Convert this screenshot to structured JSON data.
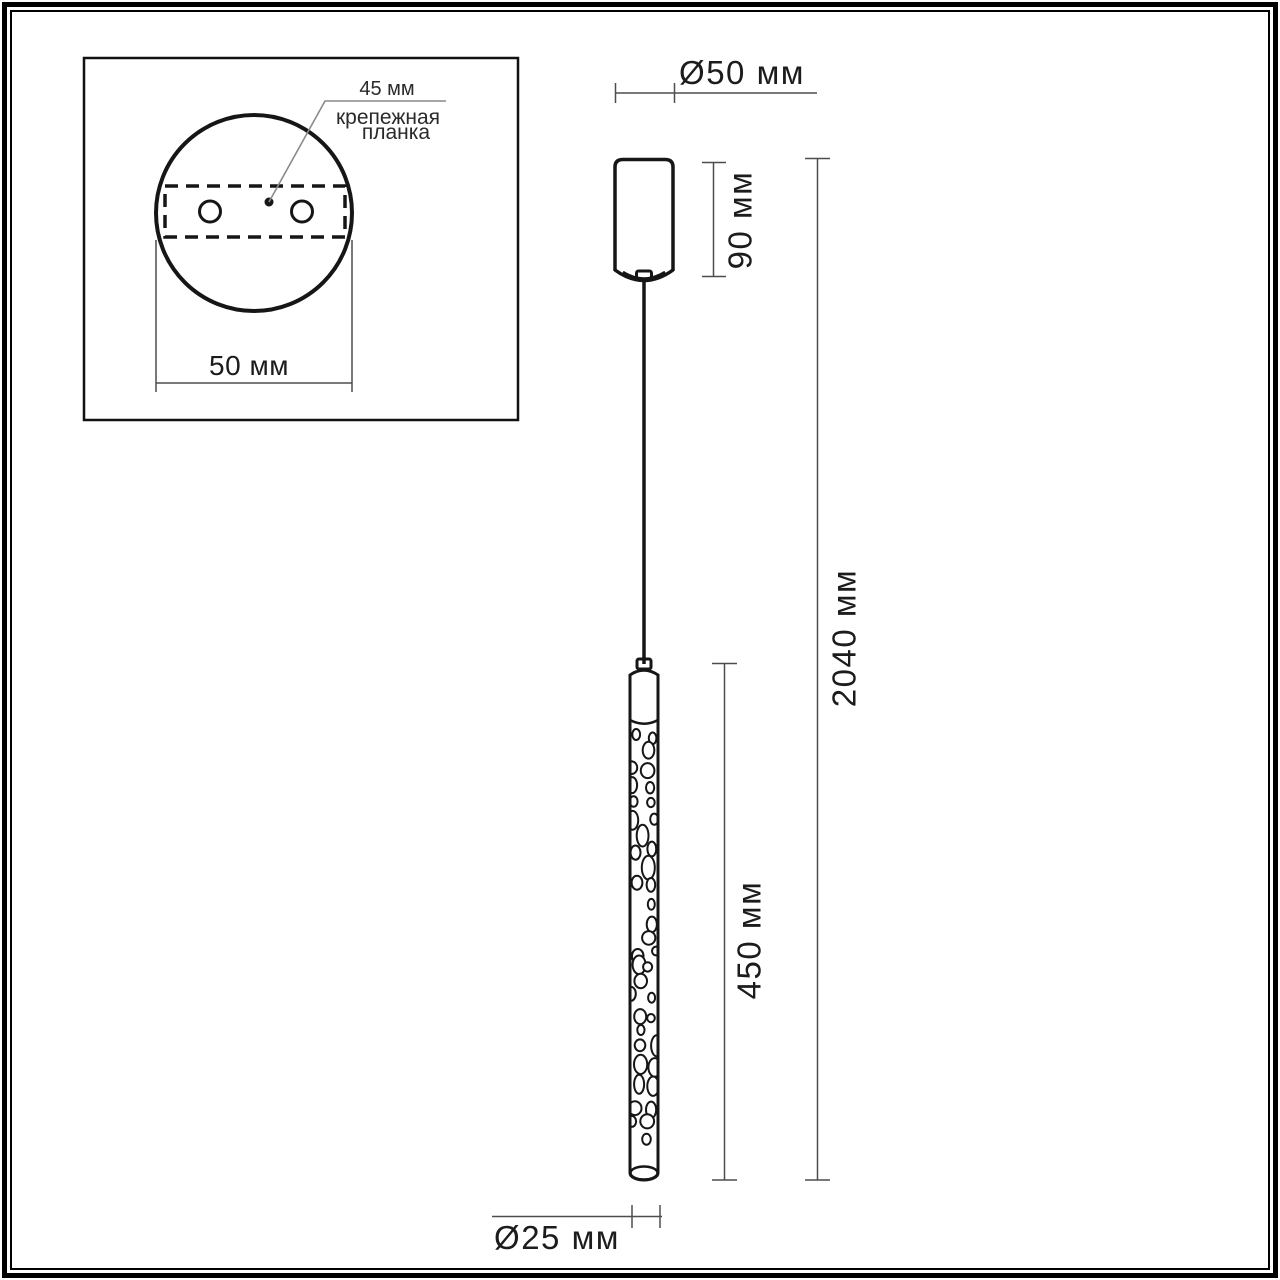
{
  "inset": {
    "bracket_width_label": "45 мм",
    "caption_line1": "крепежная",
    "caption_line2": "планка",
    "base_diameter_label": "50 мм"
  },
  "pendant": {
    "canopy_diameter_label": "Ø50 мм",
    "canopy_height_label": "90 мм",
    "overall_height_label": "2040 мм",
    "shade_length_label": "450 мм",
    "shade_diameter_label": "Ø25 мм"
  },
  "colors": {
    "drawing_line": "#161616",
    "dimension_line": "#4d4d4d",
    "background": "#ffffff"
  }
}
